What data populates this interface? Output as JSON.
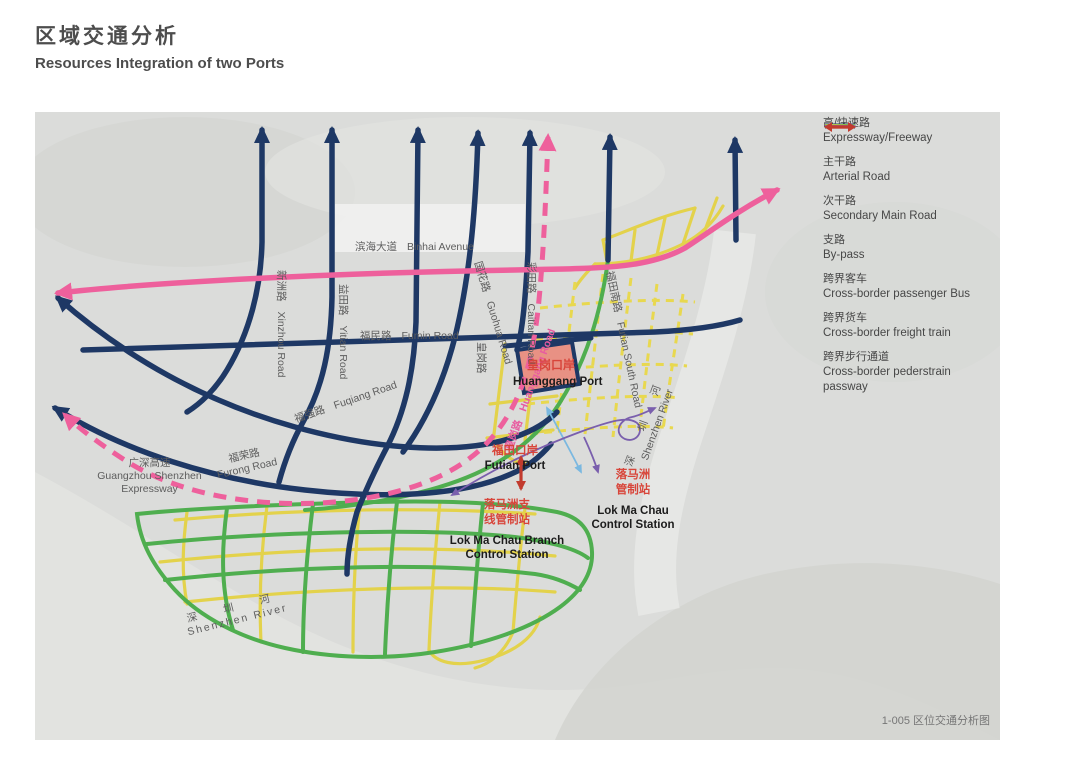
{
  "page": {
    "title_zh": "区域交通分析",
    "title_en": "Resources Integration of two Ports"
  },
  "legend": {
    "items": [
      {
        "zh": "高/快速路",
        "en": "Expressway/Freeway",
        "color": "#ee609c",
        "style": "line"
      },
      {
        "zh": "主干路",
        "en": "Arterial Road",
        "color": "#1e3865",
        "style": "line"
      },
      {
        "zh": "次干路",
        "en": "Secondary Main Road",
        "color": "#4fae4f",
        "style": "line"
      },
      {
        "zh": "支路",
        "en": "By-pass",
        "color": "#e3d24b",
        "style": "line"
      },
      {
        "zh": "跨界客车",
        "en": "Cross-border passenger Bus",
        "color": "#7ab8e0",
        "style": "arrow"
      },
      {
        "zh": "跨界货车",
        "en": "Cross-border freight train",
        "color": "#7a5fad",
        "style": "arrow"
      },
      {
        "zh": "跨界步行通道",
        "en": "Cross-border pederstrain passway",
        "color": "#c23b2e",
        "style": "double-arrow"
      }
    ]
  },
  "map": {
    "labels": {
      "binhai": {
        "zh": "滨海大道",
        "en": "Binhai Avenue"
      },
      "xinzhou": {
        "zh": "新洲路",
        "en": "Xinzhou Road"
      },
      "yitian": {
        "zh": "益田路",
        "en": "Yitian Road"
      },
      "fumin": {
        "zh": "福民路",
        "en": "Fumin Road"
      },
      "guohua": {
        "zh": "国花路",
        "en": "Guohua Road"
      },
      "caitian": {
        "zh": "彩田路",
        "en": "Caitian Road"
      },
      "futian_south": {
        "zh": "福田南路",
        "en": "Futian South Road"
      },
      "huanggang_road": {
        "zh": "皇岗路",
        "en": "Huanggang Road"
      },
      "huanggang_road_gray": {
        "zh": "皇岗路"
      },
      "fuqiang": {
        "zh": "福强路",
        "en": "Fuqiang Road"
      },
      "furong": {
        "zh": "福荣路",
        "en": "Furong Road"
      },
      "gz_expressway": {
        "zh": "广深高速",
        "en1": "Guangzhou Shenzhen",
        "en2": "Expressway"
      },
      "river": {
        "zh": "深  圳  河",
        "en": "Shenzhen River"
      }
    },
    "ports": {
      "huanggang": {
        "zh": "皇岗口岸",
        "en": "Huanggang Port"
      },
      "futian": {
        "zh": "福田口岸",
        "en": "Futian Port"
      },
      "lok_ma_chau_branch": {
        "zh1": "落马洲支",
        "zh2": "线管制站",
        "en1": "Lok Ma Chau Branch",
        "en2": "Control Station"
      },
      "lok_ma_chau": {
        "zh1": "落马洲",
        "zh2": "管制站",
        "en1": "Lok Ma Chau",
        "en2": "Control Station"
      }
    },
    "caption": "1-005 区位交通分析图"
  }
}
